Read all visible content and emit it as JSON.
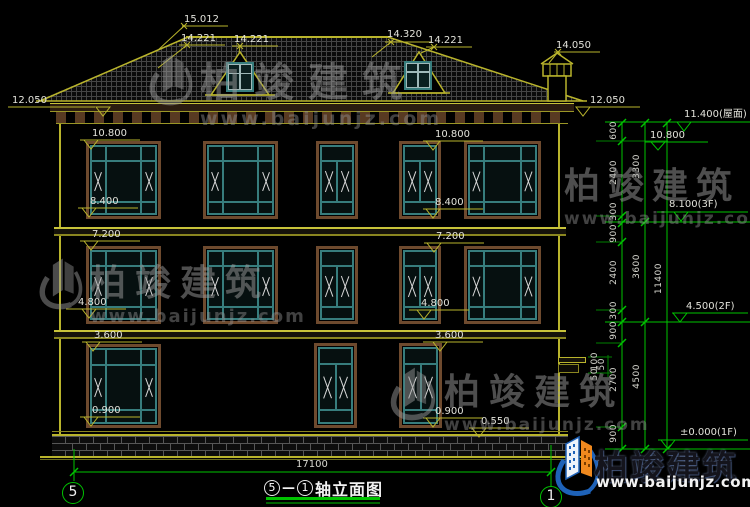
{
  "colors": {
    "cad_yellow": "#b9b42c",
    "cad_green": "#00c300",
    "window_teal": "#377d7d",
    "frame_brown": "#6e4a2e",
    "brand_blue": "#1e62b8",
    "brand_orange": "#f0891e"
  },
  "watermark": {
    "name": "柏竣建筑",
    "url": "www.baijunjz.com"
  },
  "brand": {
    "name": "柏竣建筑",
    "url": "www.baijunjz.com"
  },
  "roof_labels": {
    "ridge": "15.012",
    "left_slope": "14.221",
    "dormer_left": "14.221",
    "ridge_right": "14.320",
    "dormer_right": "14.221",
    "chimney": "14.050",
    "eave_left": "12.050",
    "eave_right": "12.050"
  },
  "left_levels": {
    "l10800": "10.800",
    "l8400": "8.400",
    "l7200": "7.200",
    "l4800": "4.800",
    "l3600": "3.600",
    "l0900": "0.900"
  },
  "mid_levels": {
    "l10800": "10.800",
    "l8400": "8.400",
    "l7200": "7.200",
    "l4800": "4.800",
    "l3600": "3.600",
    "l0900": "0.900",
    "l0550": "0.550"
  },
  "elevation_marks": {
    "roof": "11.400(屋面)",
    "m10800": "10.800",
    "f3": "8.100(3F)",
    "f2": "4.500(2F)",
    "f1": "±0.000(1F)"
  },
  "dims": {
    "chain_inner": [
      "600",
      "2400",
      "300",
      "900",
      "2400",
      "300",
      "900",
      "2700",
      "900"
    ],
    "chain_small": [
      "100",
      "50",
      "50"
    ],
    "chain_story": [
      "3300",
      "3600",
      "4500"
    ],
    "overall_height": "11400",
    "overall_width": "17100"
  },
  "title_block": {
    "axis_start": "5",
    "separator": "—",
    "axis_end": "1",
    "name": "轴立面图"
  },
  "axis_bubbles": {
    "left": "5",
    "right": "1"
  }
}
